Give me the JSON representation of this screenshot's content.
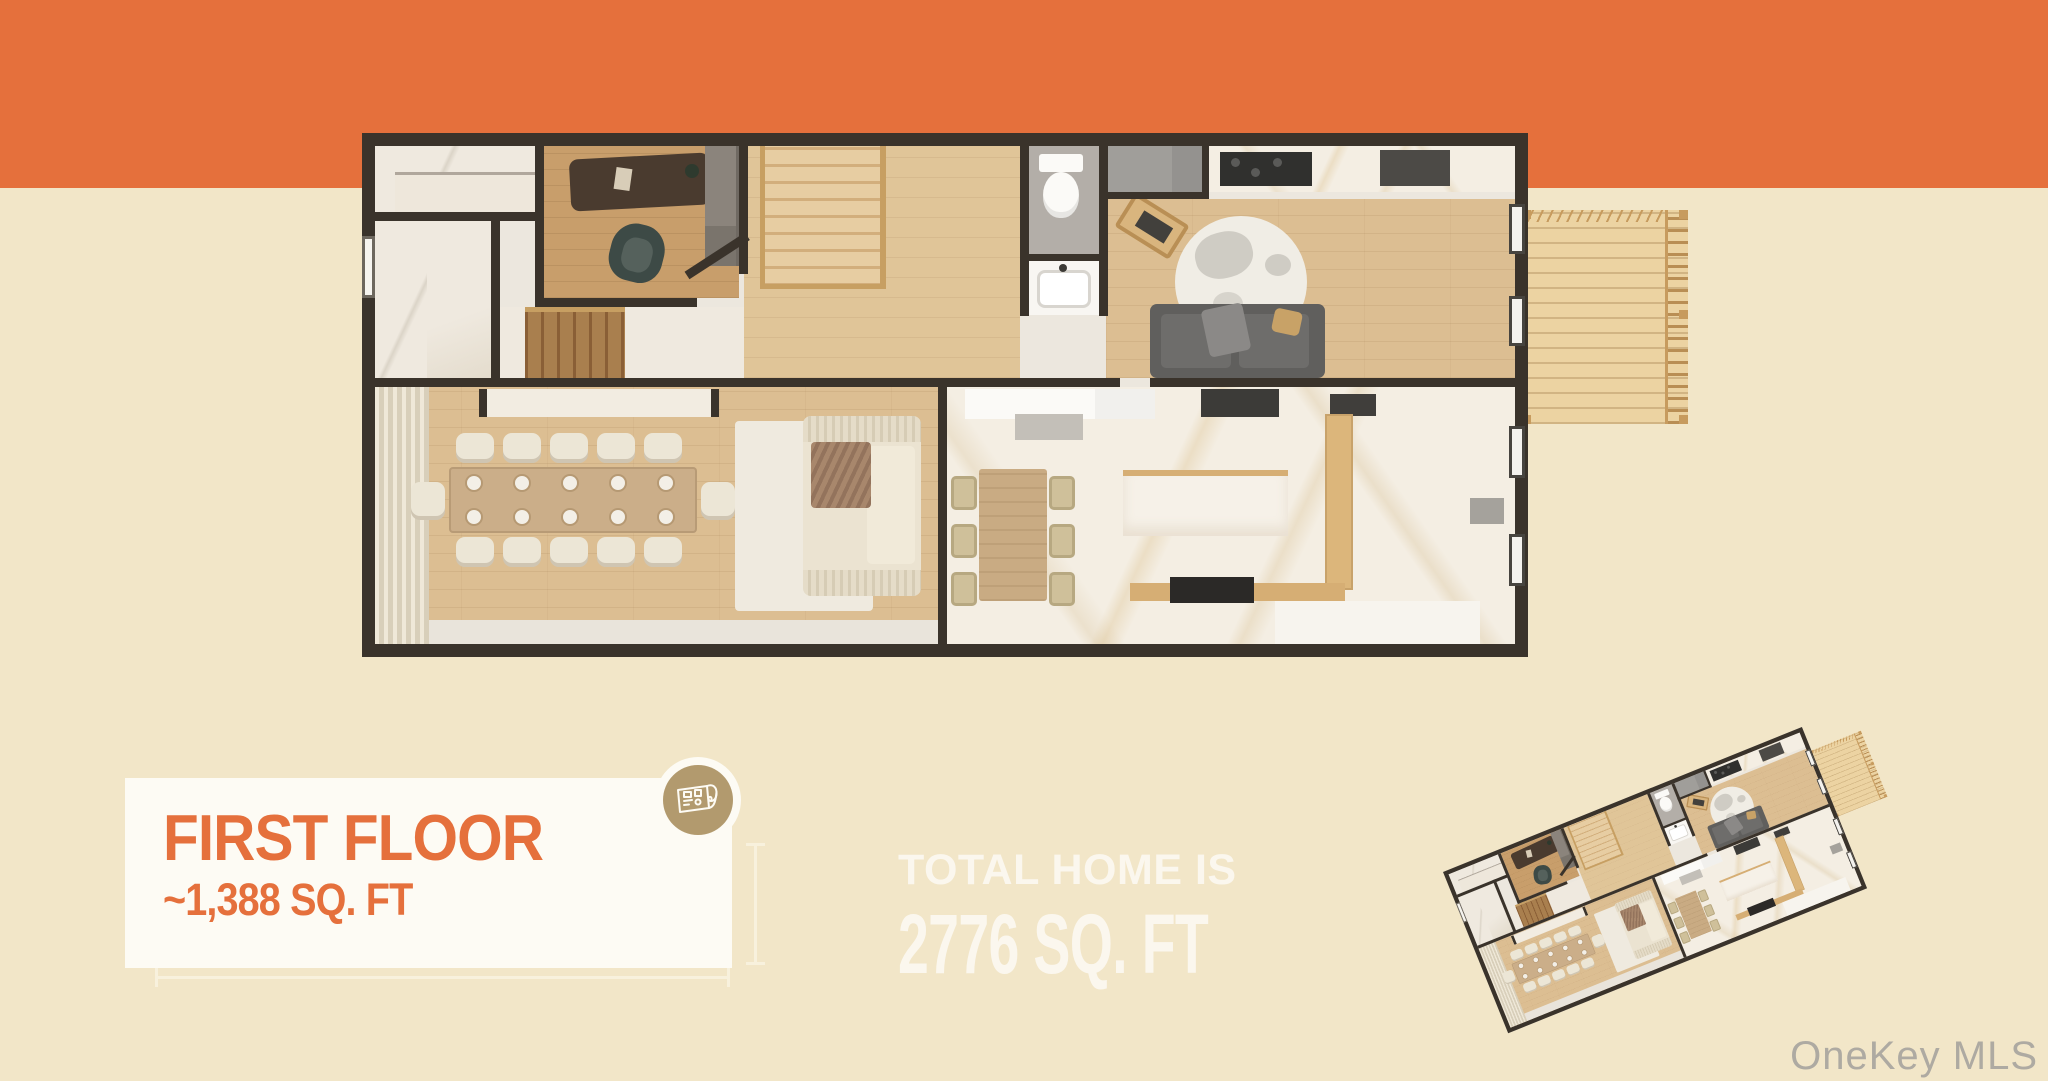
{
  "colors": {
    "background": "#f2e6c8",
    "accent": "#e5703c",
    "card": "#fdfbf4",
    "badge": "#b29a6e",
    "wall": "#3a332b"
  },
  "info_card": {
    "title": "FIRST FLOOR",
    "subtitle": "~1,388 SQ. FT"
  },
  "total_callout": {
    "line1": "TOTAL HOME IS",
    "line2": "2776 SQ. FT"
  },
  "watermark": "OneKey MLS",
  "icons": [
    {
      "name": "blueprint-icon",
      "meaning": "rolled floor plan drawing"
    }
  ]
}
